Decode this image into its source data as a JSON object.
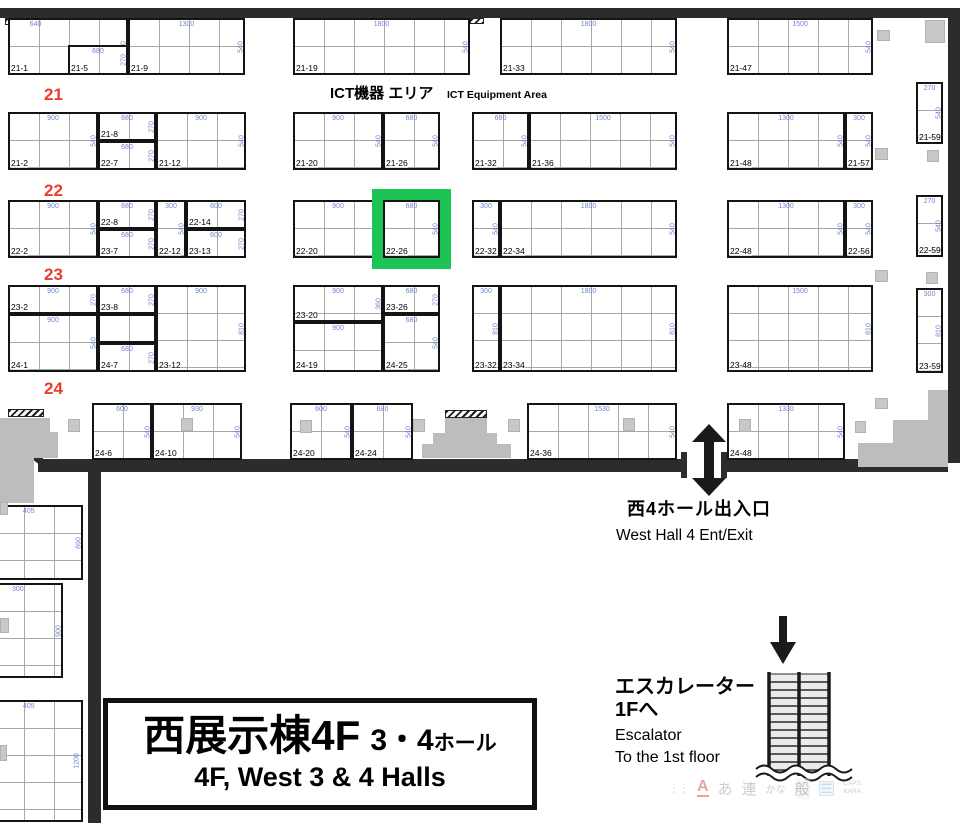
{
  "colors": {
    "highlight_green": "#1ec355",
    "row_label_red": "#ee3a2c",
    "dimension_blue": "#7183cb",
    "wall_dark": "#2c2c2c",
    "pillar_gray": "#c8c8c6"
  },
  "area_label": {
    "jp": "ICT機器 エリア",
    "en": "ICT Equipment Area"
  },
  "row_labels": [
    {
      "text": "21",
      "x": 44,
      "y": 86
    },
    {
      "text": "22",
      "x": 44,
      "y": 182
    },
    {
      "text": "23",
      "x": 44,
      "y": 266
    },
    {
      "text": "24",
      "x": 44,
      "y": 380
    }
  ],
  "highlight": {
    "booth_label": "22-26"
  },
  "booths": [
    {
      "l": "21-1",
      "x": 8,
      "y": 18,
      "w": 120,
      "h": 57,
      "dt": "640",
      "dtx": 22,
      "dr": "540"
    },
    {
      "l": "21-5",
      "x": 68,
      "y": 45,
      "w": 60,
      "h": 30,
      "dt": "680",
      "dr": "270"
    },
    {
      "l": "21-9",
      "x": 128,
      "y": 18,
      "w": 117,
      "h": 57,
      "dt": "1300",
      "dr": "540"
    },
    {
      "l": "21-19",
      "x": 293,
      "y": 18,
      "w": 177,
      "h": 57,
      "dt": "1800",
      "dr": "540"
    },
    {
      "l": "21-33",
      "x": 500,
      "y": 18,
      "w": 177,
      "h": 57,
      "dt": "1800",
      "dr": "540"
    },
    {
      "l": "21-47",
      "x": 727,
      "y": 18,
      "w": 146,
      "h": 57,
      "dt": "1500",
      "dr": "540"
    },
    {
      "l": "21-2",
      "x": 8,
      "y": 112,
      "w": 90,
      "h": 58,
      "dt": "900",
      "dr": "540"
    },
    {
      "l": "21-8",
      "x": 98,
      "y": 112,
      "w": 58,
      "h": 29,
      "dt": "680",
      "dr": "270"
    },
    {
      "l": "22-7",
      "x": 98,
      "y": 141,
      "w": 58,
      "h": 29,
      "dt": "680",
      "dr": "270"
    },
    {
      "l": "21-12",
      "x": 156,
      "y": 112,
      "w": 90,
      "h": 58,
      "dt": "900",
      "dr": "540"
    },
    {
      "l": "21-20",
      "x": 293,
      "y": 112,
      "w": 90,
      "h": 58,
      "dt": "900",
      "dr": "540"
    },
    {
      "l": "21-26",
      "x": 383,
      "y": 112,
      "w": 57,
      "h": 58,
      "dt": "680",
      "dr": "540"
    },
    {
      "l": "21-32",
      "x": 472,
      "y": 112,
      "w": 57,
      "h": 58,
      "dt": "680",
      "dr": "540"
    },
    {
      "l": "21-36",
      "x": 529,
      "y": 112,
      "w": 148,
      "h": 58,
      "dt": "1500",
      "dr": "540"
    },
    {
      "l": "21-48",
      "x": 727,
      "y": 112,
      "w": 118,
      "h": 58,
      "dt": "1300",
      "dr": "540"
    },
    {
      "l": "21-57",
      "x": 845,
      "y": 112,
      "w": 28,
      "h": 58,
      "dt": "300",
      "dr": "540"
    },
    {
      "l": "21-59",
      "x": 916,
      "y": 82,
      "w": 27,
      "h": 62,
      "dt": "270",
      "dr": "540"
    },
    {
      "l": "22-2",
      "x": 8,
      "y": 200,
      "w": 90,
      "h": 58,
      "dt": "900",
      "dr": "540"
    },
    {
      "l": "22-8",
      "x": 98,
      "y": 200,
      "w": 58,
      "h": 29,
      "dt": "680",
      "dr": "270"
    },
    {
      "l": "23-7",
      "x": 98,
      "y": 229,
      "w": 58,
      "h": 29,
      "dt": "680",
      "dr": "270"
    },
    {
      "l": "22-12",
      "x": 156,
      "y": 200,
      "w": 30,
      "h": 58,
      "dt": "300",
      "dr": "540"
    },
    {
      "l": "22-14",
      "x": 186,
      "y": 200,
      "w": 60,
      "h": 29,
      "dt": "600",
      "dr": "270"
    },
    {
      "l": "23-13",
      "x": 186,
      "y": 229,
      "w": 60,
      "h": 29,
      "dt": "600",
      "dr": "270"
    },
    {
      "l": "22-20",
      "x": 293,
      "y": 200,
      "w": 90,
      "h": 58,
      "dt": "900",
      "dr": "540"
    },
    {
      "l": "22-26",
      "x": 383,
      "y": 200,
      "w": 57,
      "h": 58,
      "dt": "680",
      "dr": "540"
    },
    {
      "l": "22-32",
      "x": 472,
      "y": 200,
      "w": 28,
      "h": 58,
      "dt": "300",
      "dr": "540"
    },
    {
      "l": "22-34",
      "x": 500,
      "y": 200,
      "w": 177,
      "h": 58,
      "dt": "1800",
      "dr": "540"
    },
    {
      "l": "22-48",
      "x": 727,
      "y": 200,
      "w": 118,
      "h": 58,
      "dt": "1300",
      "dr": "540"
    },
    {
      "l": "22-56",
      "x": 845,
      "y": 200,
      "w": 28,
      "h": 58,
      "dt": "300",
      "dr": "540"
    },
    {
      "l": "22-59",
      "x": 916,
      "y": 195,
      "w": 27,
      "h": 62,
      "dt": "270",
      "dr": "540"
    },
    {
      "l": "23-2",
      "x": 8,
      "y": 285,
      "w": 90,
      "h": 29,
      "dt": "900",
      "dr": "270"
    },
    {
      "l": "24-1",
      "x": 8,
      "y": 314,
      "w": 90,
      "h": 58,
      "dt": "900",
      "dr": "540"
    },
    {
      "l": "23-8",
      "x": 98,
      "y": 285,
      "w": 58,
      "h": 29,
      "dt": "680",
      "dr": "270"
    },
    {
      "l": "",
      "x": 98,
      "y": 314,
      "w": 58,
      "h": 29
    },
    {
      "l": "24-7",
      "x": 98,
      "y": 343,
      "w": 58,
      "h": 29,
      "dt": "680",
      "dr": "270"
    },
    {
      "l": "23-12",
      "x": 156,
      "y": 285,
      "w": 90,
      "h": 87,
      "dt": "900",
      "dr": "810"
    },
    {
      "l": "23-20",
      "x": 293,
      "y": 285,
      "w": 90,
      "h": 37,
      "dt": "900",
      "dr": "360"
    },
    {
      "l": "24-19",
      "x": 293,
      "y": 322,
      "w": 90,
      "h": 50,
      "dt": "900"
    },
    {
      "l": "23-26",
      "x": 383,
      "y": 285,
      "w": 57,
      "h": 29,
      "dt": "680",
      "dr": "270"
    },
    {
      "l": "24-25",
      "x": 383,
      "y": 314,
      "w": 57,
      "h": 58,
      "dt": "680",
      "dr": "540"
    },
    {
      "l": "23-32",
      "x": 472,
      "y": 285,
      "w": 28,
      "h": 87,
      "dt": "300",
      "dr": "810"
    },
    {
      "l": "23-34",
      "x": 500,
      "y": 285,
      "w": 177,
      "h": 87,
      "dt": "1800",
      "dr": "810"
    },
    {
      "l": "23-48",
      "x": 727,
      "y": 285,
      "w": 146,
      "h": 87,
      "dt": "1500",
      "dr": "810"
    },
    {
      "l": "23-59",
      "x": 916,
      "y": 288,
      "w": 27,
      "h": 85,
      "dt": "300",
      "dr": "810"
    },
    {
      "l": "24-6",
      "x": 92,
      "y": 403,
      "w": 60,
      "h": 57,
      "dt": "600",
      "dr": "540"
    },
    {
      "l": "24-10",
      "x": 152,
      "y": 403,
      "w": 90,
      "h": 57,
      "dt": "930",
      "dr": "540"
    },
    {
      "l": "24-20",
      "x": 290,
      "y": 403,
      "w": 62,
      "h": 57,
      "dt": "600",
      "dr": "540"
    },
    {
      "l": "24-24",
      "x": 352,
      "y": 403,
      "w": 61,
      "h": 57,
      "dt": "680",
      "dr": "540"
    },
    {
      "l": "24-36",
      "x": 527,
      "y": 403,
      "w": 150,
      "h": 57,
      "dt": "1530",
      "dr": "540"
    },
    {
      "l": "24-48",
      "x": 727,
      "y": 403,
      "w": 118,
      "h": 57,
      "dt": "1330",
      "dr": "540"
    },
    {
      "l": "-32",
      "x": -37,
      "y": 505,
      "w": 120,
      "h": 75,
      "dt": "405",
      "dtx": 55,
      "dr": "690"
    },
    {
      "l": "-36",
      "x": -37,
      "y": 583,
      "w": 100,
      "h": 95,
      "dt": "300",
      "dtx": 55,
      "dr": "900"
    },
    {
      "l": "",
      "x": -37,
      "y": 700,
      "w": 120,
      "h": 122,
      "dt": "405",
      "dtx": 55,
      "dr": "1200"
    }
  ],
  "pillars": [
    [
      877,
      30,
      13,
      11
    ],
    [
      925,
      20,
      20,
      23
    ],
    [
      875,
      148,
      13,
      12
    ],
    [
      927,
      150,
      12,
      12
    ],
    [
      875,
      270,
      13,
      12
    ],
    [
      926,
      272,
      12,
      12
    ],
    [
      68,
      419,
      12,
      13
    ],
    [
      181,
      418,
      12,
      13
    ],
    [
      300,
      420,
      12,
      13
    ],
    [
      413,
      419,
      12,
      13
    ],
    [
      508,
      419,
      12,
      13
    ],
    [
      623,
      418,
      12,
      13
    ],
    [
      739,
      419,
      12,
      13
    ],
    [
      855,
      421,
      11,
      12
    ],
    [
      875,
      398,
      13,
      11
    ],
    [
      0,
      502,
      8,
      13
    ],
    [
      0,
      618,
      9,
      15
    ],
    [
      0,
      745,
      7,
      16
    ]
  ],
  "entrance": {
    "jp": "西4ホール出入口",
    "en": "West Hall 4 Ent/Exit"
  },
  "escalator": {
    "jp1": "エスカレーター",
    "jp2": "1Fへ",
    "en1": "Escalator",
    "en2": "To the 1st floor"
  },
  "title_box": {
    "jp_main": "西展示棟4F",
    "jp_num": "3・4",
    "jp_hall": "ホール",
    "en": "4F, West 3 & 4 Halls"
  },
  "ime_bar": {
    "a": "A",
    "hira": "あ",
    "ren": "連",
    "kana_small": "かな",
    "gen": "般",
    "list_icon": "☰",
    "caps": "CAPS",
    "kana": "KANA"
  }
}
